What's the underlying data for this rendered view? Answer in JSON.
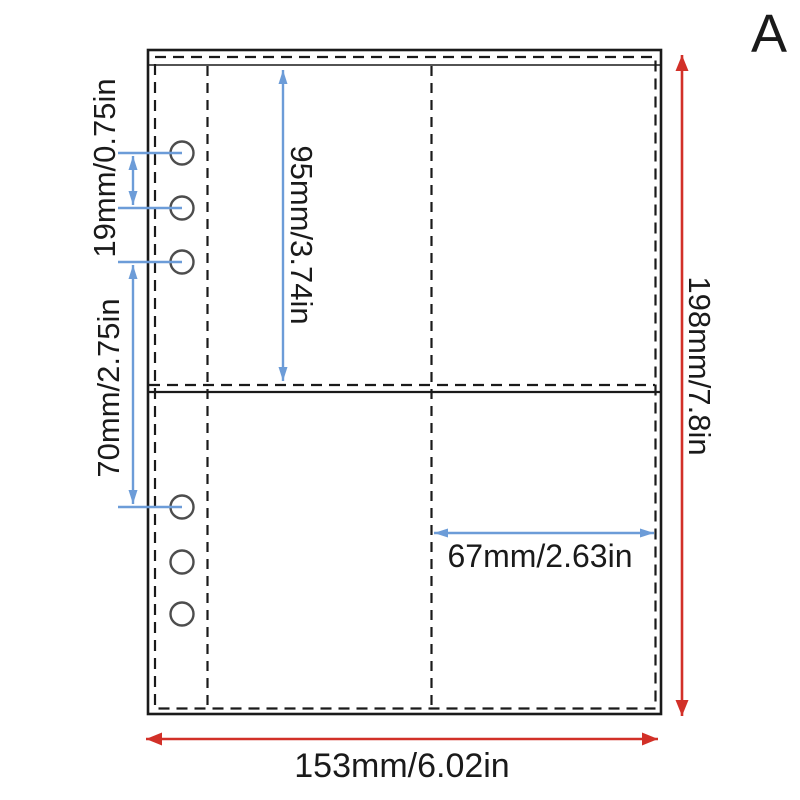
{
  "image": {
    "variant_label": "A"
  },
  "colors": {
    "dimension_blue": "#6c9cd8",
    "dimension_red": "#d23028",
    "outline_black": "#1a1a1a",
    "hole_gray": "#4d4d4d",
    "text_black": "#1a1a1a"
  },
  "dimensions": {
    "hole_pitch": "19mm/0.75in",
    "top_pocket_height": "95mm/3.74in",
    "hole_group_height": "70mm/2.75in",
    "pocket_width": "67mm/2.63in",
    "page_height": "198mm/7.8in",
    "page_width": "153mm/6.02in"
  },
  "figure": {
    "binder_holes_count": 6,
    "pocket_rows": 2,
    "pocket_columns": 2
  }
}
